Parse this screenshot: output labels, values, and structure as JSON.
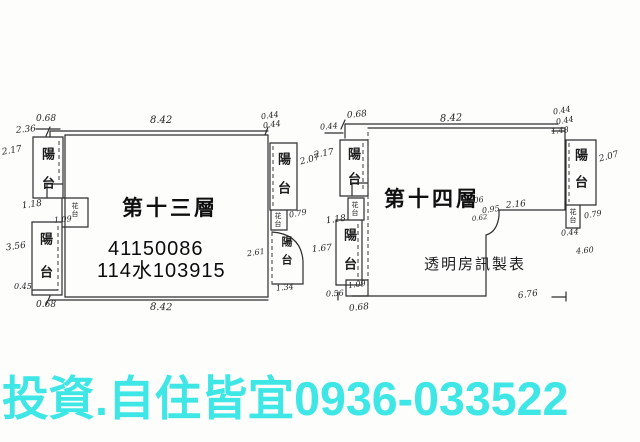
{
  "banner": {
    "text": "投資.自住皆宜0936-033522",
    "color": "#3ee7e6"
  },
  "plan13": {
    "title": "第十三層",
    "stamp_line1": "41150086",
    "stamp_line2": "114水103915",
    "balcony_top_left": "陽台",
    "balcony_bottom_left": "陽台",
    "balcony_top_right": "陽台",
    "balcony_mid_right": "陽台",
    "planter_left": "花台",
    "planter_right": "花台",
    "dims": {
      "top_width": "8.42",
      "bottom_width": "8.42",
      "top_left_small": "0.68",
      "top_left_corner": "2.36",
      "top_right_small_a": "0.44",
      "top_right_small_b": "0.44",
      "left_upper": "2.17",
      "left_middle": "1.18",
      "left_inner": "1.09",
      "left_lower": "3.56",
      "bottom_left_a": "0.45",
      "bottom_left_b": "0.68",
      "bottom_right": "1.34",
      "right_upper": "2.07",
      "right_middle": "0.79",
      "right_lower": "2.61"
    }
  },
  "plan14": {
    "title": "第十四層",
    "credit": "透明房訊製表",
    "balcony_top_left": "陽台",
    "balcony_bottom_left": "陽台",
    "balcony_right": "陽台",
    "planter_left": "花台",
    "planter_right": "花台",
    "dims": {
      "top_width": "8.42",
      "bottom_width": "6.76",
      "top_left_small": "0.68",
      "top_left_corner": "0.44",
      "top_right_small_a": "0.44",
      "top_right_small_b": "0.44",
      "top_right_small_c": "1.48",
      "left_upper": "2.17",
      "left_middle": "1.18",
      "left_lower": "1.67",
      "inner_box": "1.09",
      "bottom_left_a": "0.56",
      "bottom_left_b": "0.68",
      "right_upper": "2.07",
      "right_middle": "0.79",
      "right_lower_a": "0.44",
      "right_lower_b": "4.60",
      "notch_a": "4.06",
      "notch_b": "0.95",
      "notch_c": "2.16",
      "notch_d": "0.62"
    }
  }
}
